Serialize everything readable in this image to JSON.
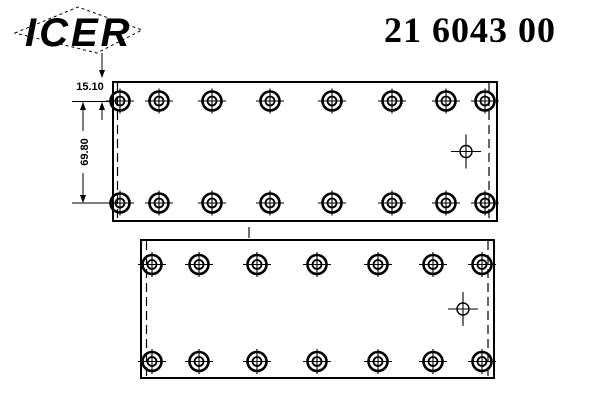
{
  "header": {
    "logo_text": "ICER",
    "part_number": "21 6043 00"
  },
  "dimensions": {
    "thickness_label": "15.10",
    "hole_row_spacing_label": "69.80"
  },
  "colors": {
    "ink": "#000000",
    "paper": "#ffffff"
  },
  "drawing": {
    "plates": [
      {
        "name": "upper-plate",
        "x": 113,
        "y": 82,
        "width": 384,
        "height": 139,
        "hole_rows_y": [
          101,
          203
        ],
        "hole_cols_x": [
          120,
          159,
          212,
          270,
          332,
          392,
          446,
          485
        ],
        "dashed_left_x": 117.5,
        "dashed_right_x": 489,
        "pilot_hole": {
          "x": 466,
          "y": 151.5
        }
      },
      {
        "name": "lower-plate",
        "x": 141,
        "y": 240,
        "width": 353,
        "height": 138,
        "hole_rows_y": [
          264.5,
          361.5
        ],
        "hole_cols_x": [
          152,
          199,
          257,
          317,
          378,
          433,
          482
        ],
        "dashed_left_x": 146.5,
        "dashed_right_x": 488,
        "pilot_hole": {
          "x": 463,
          "y": 309
        }
      }
    ],
    "rivet_hole": {
      "outer_radius": 9.5,
      "inner_radius": 4.5,
      "cross_half_width": 14,
      "cross_half_height": 12.5
    },
    "small_pilot_hole": {
      "radius": 6,
      "cross_half_width": 15,
      "cross_half_height": 17
    },
    "between_plates_tick": {
      "x": 249,
      "y1": 227,
      "y2": 238
    }
  }
}
